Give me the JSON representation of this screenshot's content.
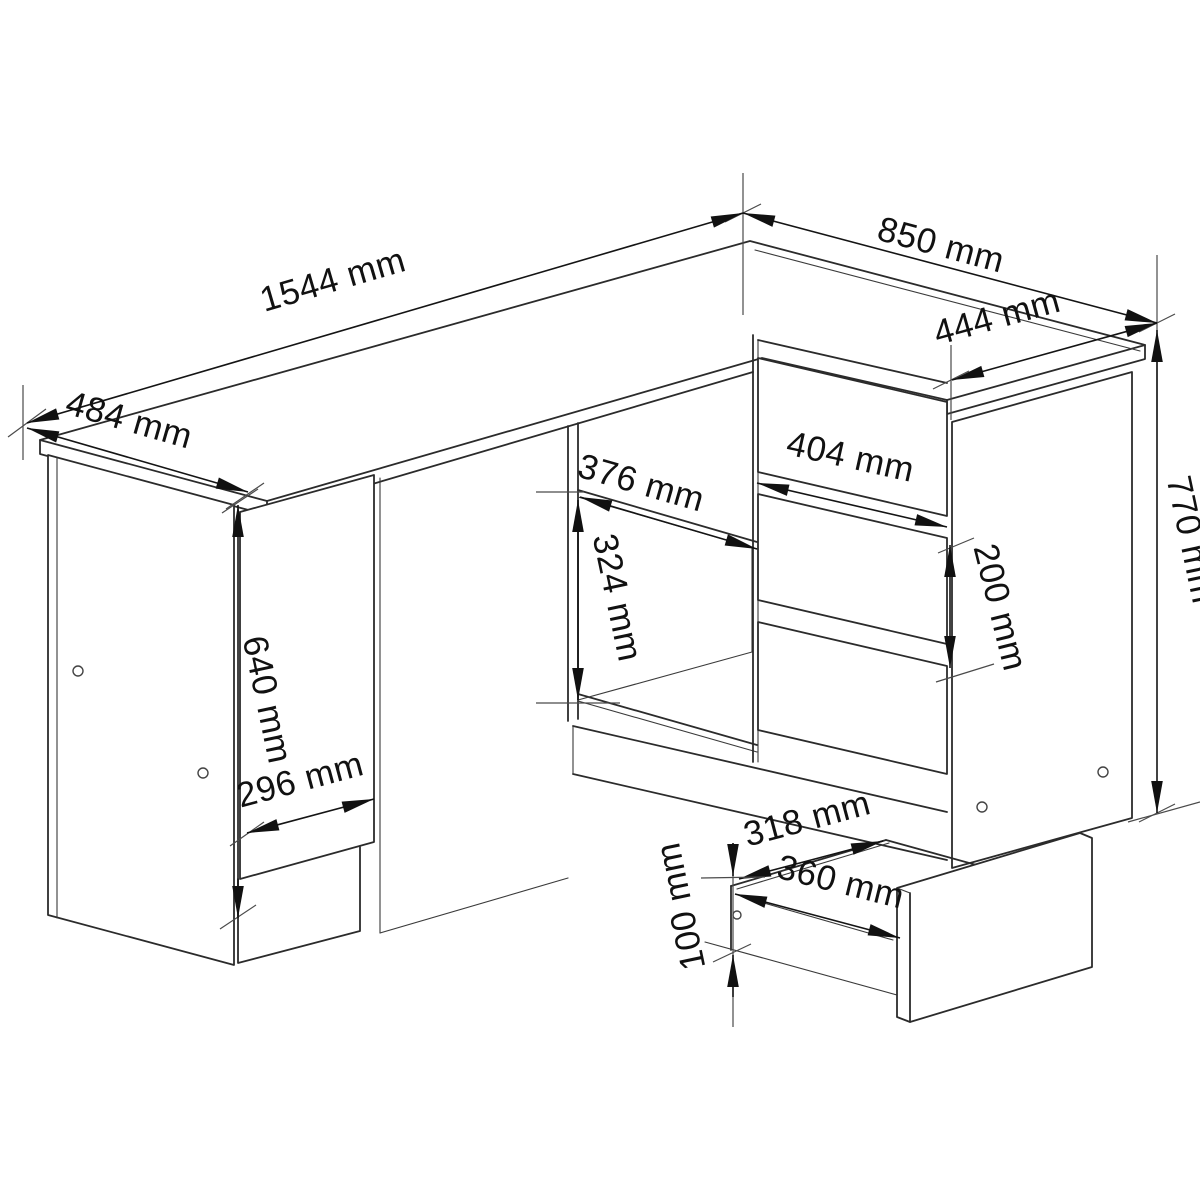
{
  "diagram": {
    "type": "furniture-assembly-dimension-drawing",
    "subject": "L-shaped corner desk with side cabinet door, open compartments and three-drawer unit with pulled-out drawer",
    "unit": "mm",
    "colors": {
      "background": "#ffffff",
      "line": "#2b2b2b",
      "dimension": "#141414",
      "text": "#111111"
    },
    "labels": {
      "desk_length": "1544 mm",
      "right_wing_depth": "850 mm",
      "right_wing_width": "444 mm",
      "left_depth": "484 mm",
      "total_height": "770 mm",
      "drawer_front_width": "404 mm",
      "drawer_pitch": "200 mm",
      "compartment_width": "376 mm",
      "compartment_height": "324 mm",
      "door_height": "640 mm",
      "door_width": "296 mm",
      "drawer_inner_width": "318 mm",
      "drawer_box_width": "360 mm",
      "drawer_inner_height": "100 mm"
    },
    "values": {
      "desk_length_mm": 1544,
      "right_wing_depth_mm": 850,
      "right_wing_width_mm": 444,
      "left_depth_mm": 484,
      "total_height_mm": 770,
      "drawer_front_width_mm": 404,
      "drawer_pitch_mm": 200,
      "compartment_width_mm": 376,
      "compartment_height_mm": 324,
      "door_height_mm": 640,
      "door_width_mm": 296,
      "drawer_inner_width_mm": 318,
      "drawer_box_width_mm": 360,
      "drawer_inner_height_mm": 100
    }
  }
}
